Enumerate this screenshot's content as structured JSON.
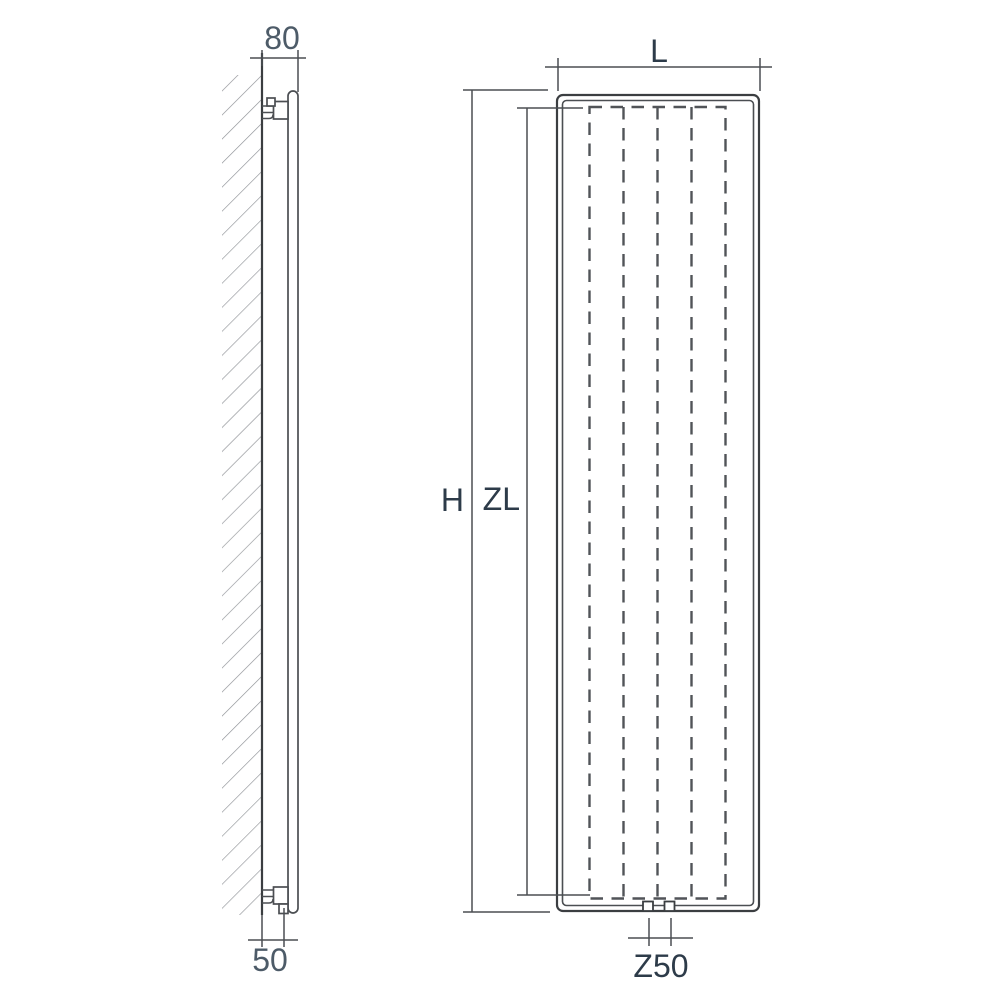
{
  "diagram": {
    "type": "technical-drawing",
    "subject": "vertical-panel-radiator-dimension-drawing",
    "labels": {
      "side_depth": "80",
      "side_bottom_offset": "50",
      "front_length": "L",
      "front_height": "H",
      "front_inner_height": "ZL",
      "front_connection_spacing": "Z50"
    },
    "colors": {
      "background": "#ffffff",
      "line": "#4b4e52",
      "line_dark": "#3b3e41",
      "dash": "#515458",
      "hatch": "#8f9297",
      "label_side": "#4d5b68",
      "label_front": "#2d3b49"
    }
  }
}
